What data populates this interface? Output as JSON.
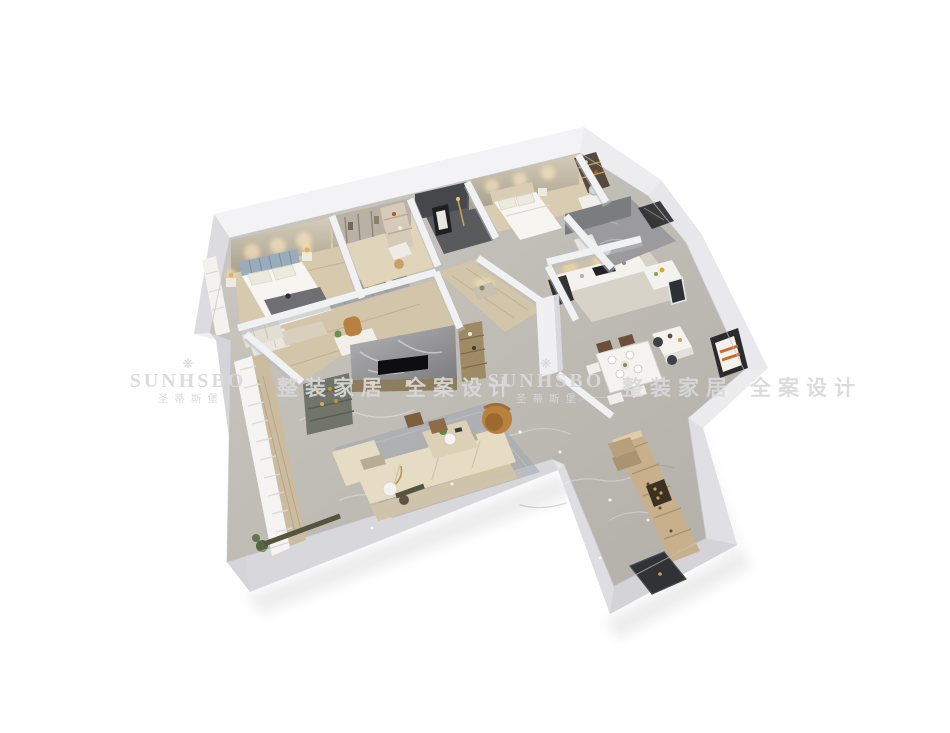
{
  "watermark": {
    "crown_glyph": "❋",
    "brand": "SUNHSBO",
    "brand_cn": "圣蒂斯堡",
    "slogan_left": "整装家居",
    "slogan_right": "全案设计"
  },
  "colors": {
    "background": "#ffffff",
    "wall_top": "#f0f0f2",
    "wall_side": "#d7d7db",
    "wood_floor": "#d6c9ae",
    "marble_floor": "#c7c3bd",
    "dark_room": "#55565a",
    "beige_wall": "#c9c0ad",
    "sofa": "#e6dcc4",
    "accent_tan": "#b8813f",
    "headboard_blue": "#9aacbc",
    "cabinet_tan": "#c9b08c",
    "watermark_text": "#d9d9d9"
  },
  "scene": {
    "type": "3d-isometric-floor-plan-render",
    "rooms": [
      "master-bedroom",
      "walk-in-closet",
      "dark-feature-room",
      "bedroom-2",
      "bathroom",
      "kitchen",
      "dining-area",
      "hallway",
      "study",
      "living-room",
      "balcony",
      "foyer"
    ]
  }
}
